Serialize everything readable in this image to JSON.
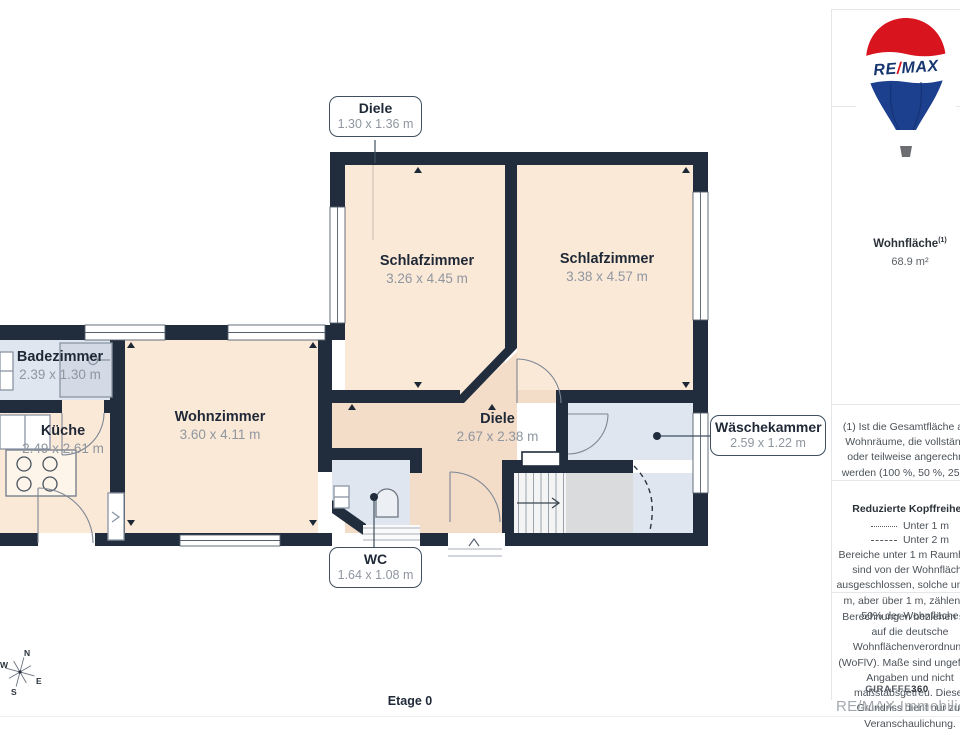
{
  "floorplan": {
    "floor_label": "Etage 0",
    "rooms": [
      {
        "name": "Schlafzimmer",
        "dims": "3.26 x 4.45 m"
      },
      {
        "name": "Schlafzimmer",
        "dims": "3.38 x 4.57 m"
      },
      {
        "name": "Badezimmer",
        "dims": "2.39 x 1.30 m"
      },
      {
        "name": "Küche",
        "dims": "2.49 x 2.61 m"
      },
      {
        "name": "Wohnzimmer",
        "dims": "3.60 x 4.11 m"
      },
      {
        "name": "Diele",
        "dims": "2.67 x 2.38 m"
      }
    ],
    "callouts": [
      {
        "name": "Diele",
        "dims": "1.30 x 1.36 m"
      },
      {
        "name": "Wäschekammer",
        "dims": "2.59 x 1.22 m"
      },
      {
        "name": "WC",
        "dims": "1.64 x 1.08 m"
      }
    ]
  },
  "compass": {
    "n": "N",
    "e": "E",
    "s": "S",
    "w": "W"
  },
  "logo": {
    "re": "RE",
    "slash": "/",
    "max": "MAX"
  },
  "sidebar": {
    "wohnflaeche_label": "Wohnfläche",
    "wohnflaeche_sup": "(1)",
    "wohnflaeche_value": "68.9 m²",
    "note1": "(1) Ist die Gesamtfläche aller Wohnräume, die vollständig oder teilweise angerechnet werden (100 %, 50 %, 25 %).",
    "kopffreiheit_title": "Reduzierte Kopffreiheit",
    "legend_unter1": "Unter 1 m",
    "legend_unter2": "Unter 2 m",
    "kopffreiheit_note": "Bereiche unter 1 m Raumhöhe sind von der Wohnfläche ausgeschlossen, solche unter 2 m, aber über 1 m, zählen als 50% der Wohnfläche",
    "berechnungen": "Berechnungen beziehen sich auf die deutsche Wohnflächenverordnung (WoFlV). Maße sind ungefähre Angaben und nicht maßstabsgetreu. Dieser Grundriss dient nur zur Veranschaulichung.",
    "brand": "GIRAFFE",
    "brand_suffix": "360"
  },
  "footer": {
    "watermark": "RE/MAX Immobilien De"
  },
  "colors": {
    "wall": "#212d3d",
    "room": "#fbe9d8",
    "hall": "#f3dcc8",
    "wet": "#dfe6ef",
    "fixture-line": "#8a95a3",
    "accent-line": "#3f4f5f",
    "remax-red": "#d8141f",
    "remax-blue": "#1c3f8e",
    "logo-text-blue": "#16356e"
  }
}
